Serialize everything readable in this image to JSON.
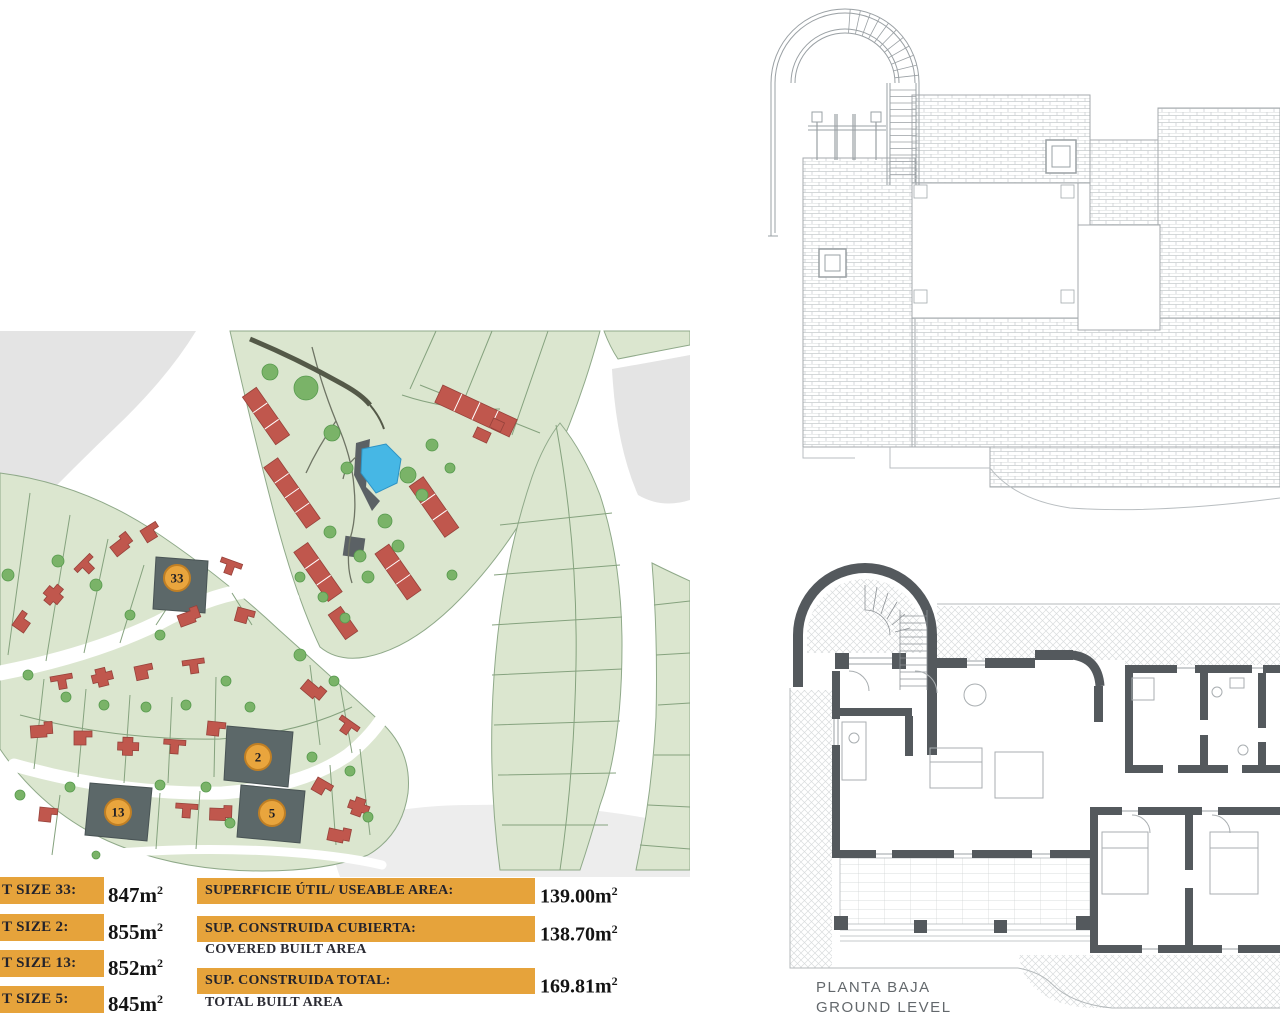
{
  "site_plan": {
    "badges": [
      {
        "number": "33"
      },
      {
        "number": "2"
      },
      {
        "number": "13"
      },
      {
        "number": "5"
      }
    ]
  },
  "plot_table": {
    "rows": [
      {
        "label": "T SIZE 33:",
        "value": "847m",
        "sup": "2"
      },
      {
        "label": "T SIZE 2:",
        "value": "855m",
        "sup": "2"
      },
      {
        "label": "T SIZE 13:",
        "value": "852m",
        "sup": "2"
      },
      {
        "label": "T SIZE 5:",
        "value": "845m",
        "sup": "2"
      }
    ]
  },
  "summary_table": {
    "rows": [
      {
        "label": "SUPERFICIE ÚTIL/ USEABLE AREA:",
        "sublabel": "",
        "value": "139.00m",
        "sup": "2"
      },
      {
        "label": "SUP. CONSTRUIDA CUBIERTA:",
        "sublabel": "COVERED BUILT AREA",
        "value": "138.70m",
        "sup": "2"
      },
      {
        "label": "SUP. CONSTRUIDA TOTAL:",
        "sublabel": "TOTAL BUILT AREA",
        "value": "169.81m",
        "sup": "2"
      }
    ]
  },
  "ground_plan": {
    "caption_line1": "PLANTA BAJA",
    "caption_line2": "GROUND LEVEL"
  },
  "colors": {
    "accent_orange": "#e6a33b",
    "highlighted_plot_gray": "#5c6869",
    "pool_blue": "#46b7e5",
    "building_red": "#c0574d",
    "plan_green": "#dbe6cf",
    "wall_gray": "#54595d"
  }
}
